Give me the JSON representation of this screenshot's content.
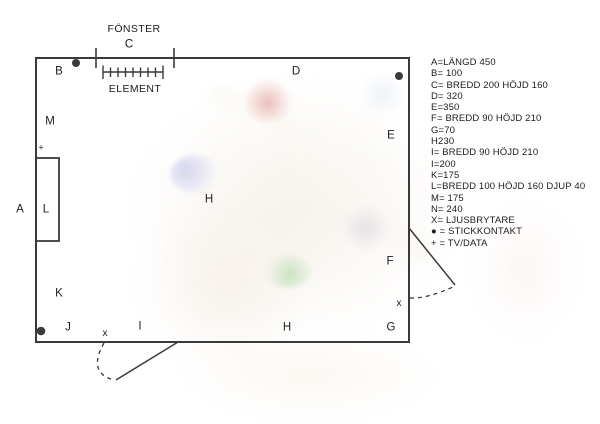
{
  "plan": {
    "window_label": "FÖNSTER",
    "radiator_label": "ELEMENT",
    "labels": {
      "a": "A",
      "b": "B",
      "c": "C",
      "d": "D",
      "e": "E",
      "f": "F",
      "g": "G",
      "h_center": "H",
      "h_bottom": "H",
      "i": "I",
      "j": "J",
      "k": "K",
      "l": "L",
      "m": "M",
      "x_bottom": "x",
      "x_right": "x",
      "tv_data_marker": "+"
    }
  },
  "legend": {
    "items": [
      "A=LÄNGD 450",
      "B= 100",
      "C= BREDD 200 HÖJD 160",
      "D= 320",
      "E=350",
      "F= BREDD 90 HÖJD 210",
      "G=70",
      "H230",
      "I= BREDD 90 HÖJD 210",
      "I=200",
      "K=175",
      "L=BREDD 100 HÖJD 160 DJUP 40",
      "M= 175",
      "N= 240",
      "X= LJUSBRYTARE",
      "● = STICKKONTAKT",
      "+ = TV/DATA"
    ]
  },
  "colors": {
    "wall": "#3a3a3a",
    "text": "#1c1c1e"
  }
}
